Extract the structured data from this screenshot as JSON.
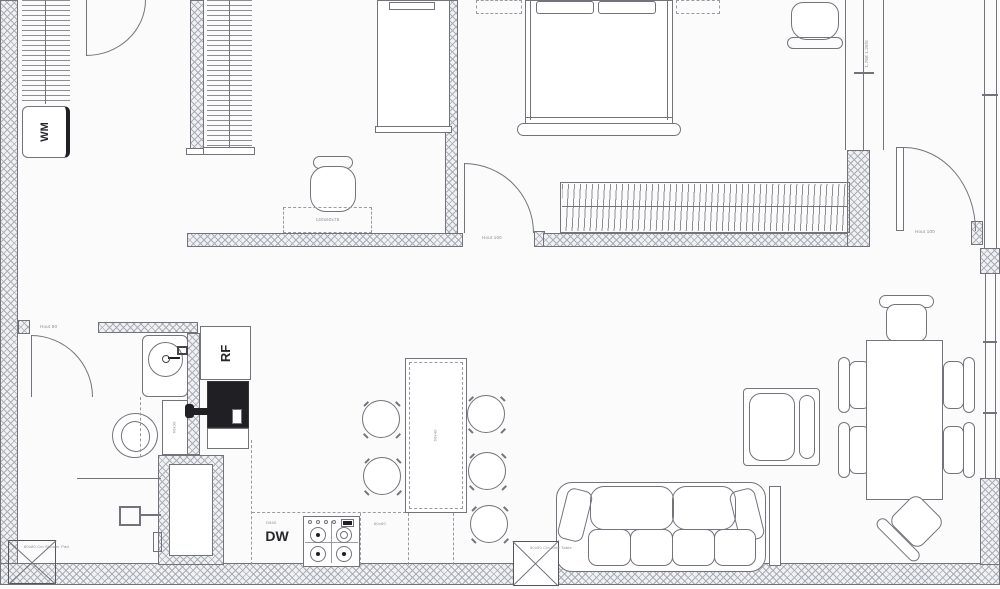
{
  "plan": {
    "type": "floor-plan",
    "labels": {
      "washing_machine": "WM",
      "refrigerator": "RF",
      "dishwasher": "DW",
      "bathroom_door": "Hout 90",
      "bedroom_door": "Hout 100",
      "entry_door": "Hout 100",
      "desk_dim": "140x60x75",
      "shower_tray": "80x80 Cm Shower Pad",
      "side_table": "50x50 Cm Side Table",
      "bedroom_window_dim": "1.768 1.26/5",
      "counter_dw_dim": "D540",
      "counter_right_dim": "60x60",
      "island_dim": "60x40",
      "bath_cabinet_dim": "60x30"
    },
    "colors": {
      "paper": "#fbfbfc",
      "line": "#73737b",
      "line_light": "#9a9aa2",
      "hatch_fill": "#f0f1f3",
      "hatch_line": "#aaacb6",
      "dark": "#1f1f24",
      "text": "#8b8b93",
      "text_dark": "#26262b"
    }
  }
}
